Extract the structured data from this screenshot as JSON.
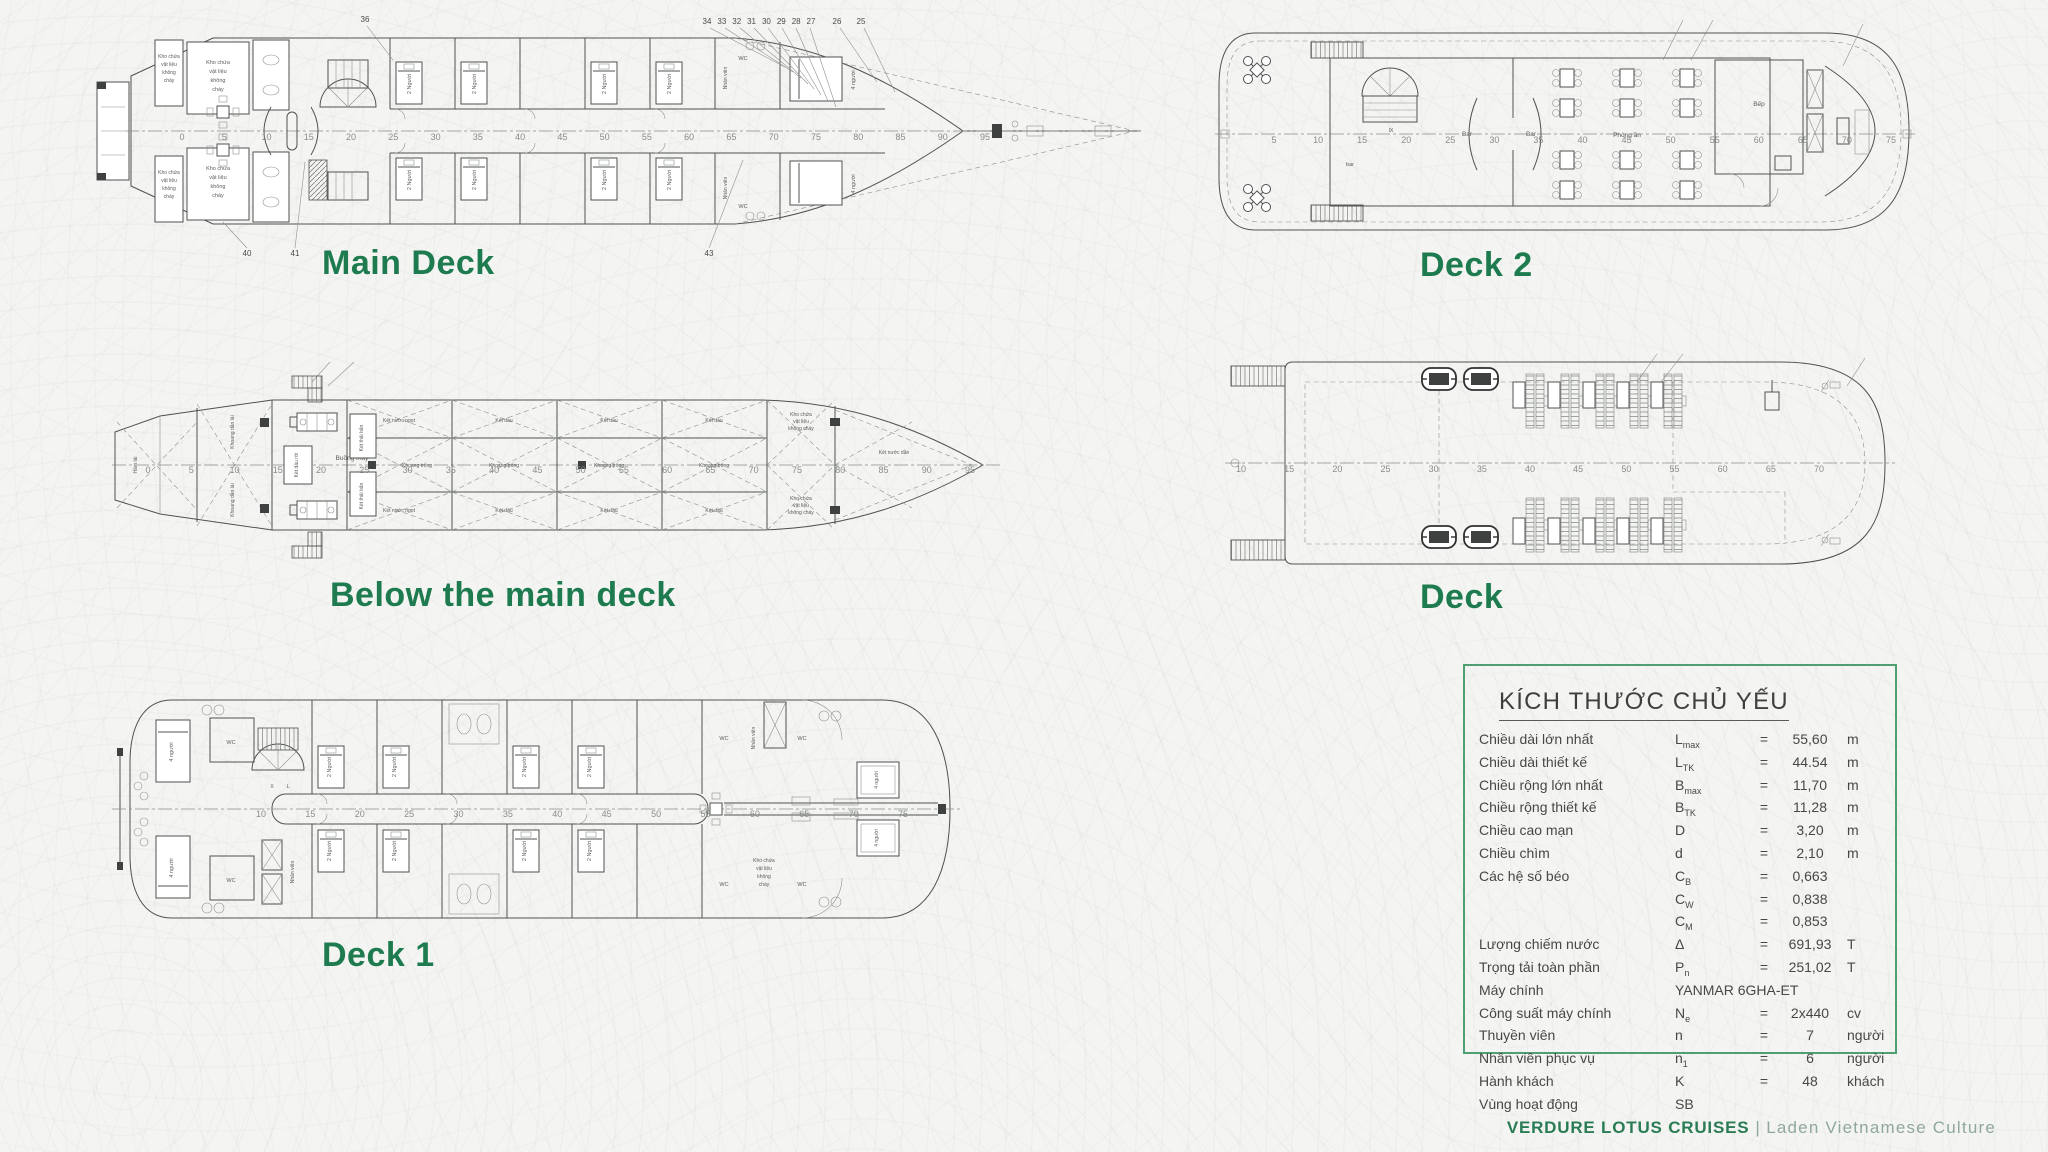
{
  "page": {
    "background": "#f4f5f2",
    "line_color": "#4f5251",
    "accent_green": "#1e7b4f",
    "table_border_green": "#4f9f74",
    "footer": {
      "brand": "VERDURE LOTUS CRUISES",
      "divider": "|",
      "tagline": "Laden Vietnamese Culture"
    }
  },
  "plans": {
    "labels": {
      "p2": "2 Người",
      "p4": "4 người",
      "wc": "WC",
      "staff": "Nhân viên",
      "sto1": "Kho chứa",
      "sto2": "vật liệu",
      "sto3": "không",
      "sto4": "cháy",
      "sto34": "không cháy",
      "bar": "Bar",
      "barl": "bar",
      "dining": "Phòng ăn",
      "kitchen": "Bếp",
      "engine": "Buồng máy",
      "fresh": "Két nước ngọt",
      "fuel": "Két dầu",
      "void": "Khoang trống",
      "bowtank": "Két nước dằn",
      "steer": "Hầm lái",
      "aftb": "Khoang dằn lái",
      "waste": "Két thải bẩn",
      "oiltank": "Két dầu rời",
      "sx": "X",
      "sl": "L",
      "six": "IX"
    },
    "main_deck": {
      "title": "Main Deck",
      "stations": [
        "0",
        "5",
        "10",
        "15",
        "20",
        "25",
        "30",
        "35",
        "40",
        "45",
        "50",
        "55",
        "60",
        "65",
        "70",
        "75",
        "80",
        "85",
        "90",
        "95"
      ],
      "callout_36": "36",
      "callouts_top": [
        "34",
        "33",
        "32",
        "31",
        "30",
        "29",
        "28",
        "27"
      ],
      "callouts_top2": [
        "26",
        "25"
      ],
      "callouts_bottom": [
        "40",
        "41",
        "43"
      ]
    },
    "deck2": {
      "title": "Deck 2",
      "stations": [
        "5",
        "10",
        "15",
        "20",
        "25",
        "30",
        "35",
        "40",
        "45",
        "50",
        "55",
        "60",
        "65",
        "70",
        "75"
      ]
    },
    "below": {
      "title": "Below the main deck",
      "stations": [
        "0",
        "5",
        "10",
        "15",
        "20",
        "25",
        "30",
        "35",
        "40",
        "45",
        "50",
        "55",
        "60",
        "65",
        "70",
        "75",
        "80",
        "85",
        "90",
        "95"
      ]
    },
    "deck": {
      "title": "Deck",
      "stations": [
        "10",
        "15",
        "20",
        "25",
        "30",
        "35",
        "40",
        "45",
        "50",
        "55",
        "60",
        "65",
        "70"
      ]
    },
    "deck1": {
      "title": "Deck 1",
      "stations": [
        "10",
        "15",
        "20",
        "25",
        "30",
        "35",
        "40",
        "45",
        "50",
        "55",
        "60",
        "65",
        "70",
        "75"
      ]
    }
  },
  "spec_table": {
    "title": "KÍCH THƯỚC CHỦ YẾU",
    "rows": [
      {
        "label": "Chiều dài lớn nhất",
        "sym": "L",
        "sub": "max",
        "eq": "=",
        "val": "55,60",
        "unit": "m"
      },
      {
        "label": "Chiều dài thiết kế",
        "sym": "L",
        "sub": "TK",
        "eq": "=",
        "val": "44.54",
        "unit": "m"
      },
      {
        "label": "Chiều rộng lớn nhất",
        "sym": "B",
        "sub": "max",
        "eq": "=",
        "val": "11,70",
        "unit": "m"
      },
      {
        "label": "Chiều rộng thiết kế",
        "sym": "B",
        "sub": "TK",
        "eq": "=",
        "val": "11,28",
        "unit": "m"
      },
      {
        "label": "Chiều cao mạn",
        "sym": "D",
        "sub": "",
        "eq": "=",
        "val": "3,20",
        "unit": "m"
      },
      {
        "label": "Chiều chìm",
        "sym": "d",
        "sub": "",
        "eq": "=",
        "val": "2,10",
        "unit": "m"
      },
      {
        "label": "Các hệ số béo",
        "sym": "C",
        "sub": "B",
        "eq": "=",
        "val": "0,663",
        "unit": ""
      },
      {
        "label": "",
        "sym": "C",
        "sub": "W",
        "eq": "=",
        "val": "0,838",
        "unit": ""
      },
      {
        "label": "",
        "sym": "C",
        "sub": "M",
        "eq": "=",
        "val": "0,853",
        "unit": ""
      },
      {
        "label": "Lượng chiếm nước",
        "sym": "Δ",
        "sub": "",
        "eq": "=",
        "val": "691,93",
        "unit": "T"
      },
      {
        "label": "Trọng tải toàn phần",
        "sym": "P",
        "sub": "n",
        "eq": "=",
        "val": "251,02",
        "unit": "T"
      },
      {
        "label": "Máy chính",
        "sym": "YANMAR 6GHA-ET",
        "sub": "",
        "eq": "",
        "val": "",
        "unit": ""
      },
      {
        "label": "Công suất máy chính",
        "sym": "N",
        "sub": "e",
        "eq": "=",
        "val": "2x440",
        "unit": "cv"
      },
      {
        "label": "Thuyền viên",
        "sym": "n",
        "sub": "",
        "eq": "=",
        "val": "7",
        "unit": "người"
      },
      {
        "label": "Nhân viên phục vụ",
        "sym": "n",
        "sub": "1",
        "eq": "=",
        "val": "6",
        "unit": "người"
      },
      {
        "label": "Hành khách",
        "sym": "K",
        "sub": "",
        "eq": "=",
        "val": "48",
        "unit": "khách"
      },
      {
        "label": "Vùng hoạt động",
        "sym": "SB",
        "sub": "",
        "eq": "",
        "val": "",
        "unit": ""
      }
    ]
  }
}
